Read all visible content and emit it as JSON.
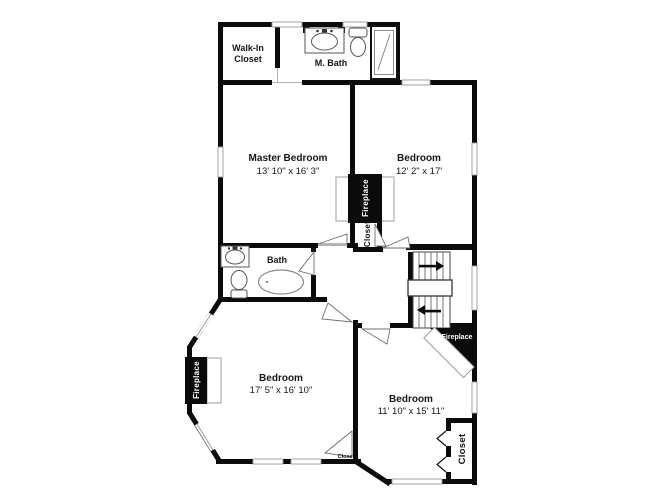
{
  "rooms": {
    "walk_in_closet": {
      "line1": "Walk-In",
      "line2": "Closet"
    },
    "m_bath": {
      "label": "M. Bath"
    },
    "master_bedroom": {
      "label": "Master Bedroom",
      "dims": "13' 10\" x 16' 3\""
    },
    "bedroom_ne": {
      "label": "Bedroom",
      "dims": "12' 2\" x 17'"
    },
    "bath": {
      "label": "Bath"
    },
    "bedroom_sw": {
      "label": "Bedroom",
      "dims": "17' 5\" x 16' 10\""
    },
    "bedroom_se": {
      "label": "Bedroom",
      "dims": "11' 10\" x 15' 11\""
    }
  },
  "features": {
    "fireplace_ne": "Fireplace",
    "fireplace_sw": "Fireplace",
    "fireplace_se": "Fireplace",
    "closet_ne": "Closet",
    "closet_sw": "Closet",
    "closet_se": "Closet"
  },
  "colors": {
    "wall": "#0b0b0b",
    "window_line": "#9a9a9a",
    "fixture_line": "#555555",
    "background": "#ffffff"
  }
}
